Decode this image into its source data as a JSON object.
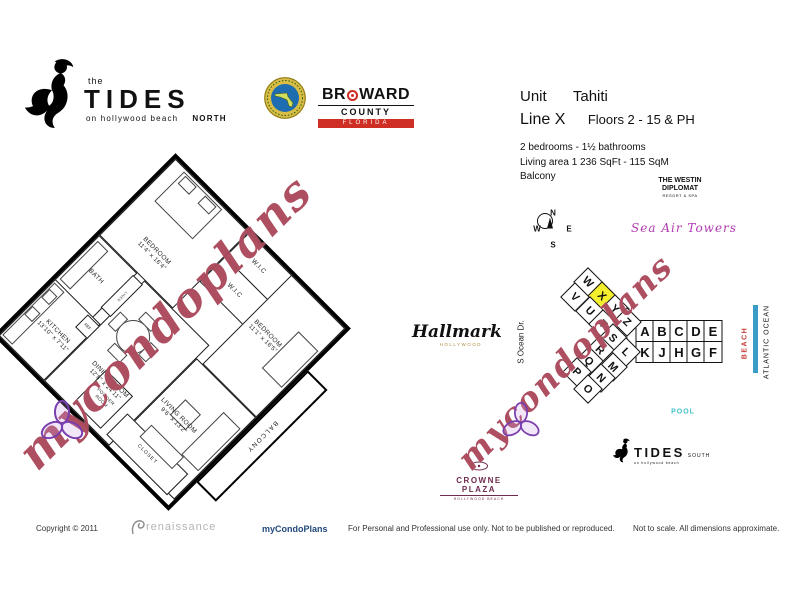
{
  "header": {
    "tides_north": {
      "the": "the",
      "name": "TIDES",
      "tagline": "on hollywood beach",
      "region": "NORTH"
    },
    "broward": {
      "line1a": "BR",
      "line1b": "WARD",
      "line2": "COUNTY",
      "line3": "FLORIDA"
    },
    "unit_info": {
      "unit_label": "Unit",
      "unit_name": "Tahiti",
      "line_label": "Line X",
      "floors": "Floors 2 - 15 & PH",
      "bedrooms": "2 bedrooms - 1½ bathrooms",
      "living_area": "Living area  1 236  SqFt - 115  SqM",
      "balcony": "Balcony"
    }
  },
  "floor_plan": {
    "rooms": [
      {
        "name": "BEDROOM",
        "dims": "11'4\" x 16'4\""
      },
      {
        "name": "W.I.C",
        "dims": ""
      },
      {
        "name": "W.I.C",
        "dims": ""
      },
      {
        "name": "BEDROOM",
        "dims": "11'1\" x 16'5\""
      },
      {
        "name": "BATH",
        "dims": ""
      },
      {
        "name": "KITCHEN",
        "dims": "13'10\" x 7'11\""
      },
      {
        "name": "DINING ROOM",
        "dims": "12'8\" x 24'11\""
      },
      {
        "name": "LIVING ROOM",
        "dims": "9'6\" x 13'2\""
      },
      {
        "name": "BALCONY",
        "dims": ""
      },
      {
        "name": "POWDER ROOM",
        "dims": ""
      },
      {
        "name": "CLOSET",
        "dims": ""
      },
      {
        "name": "REF",
        "dims": ""
      },
      {
        "name": "LINEN",
        "dims": ""
      }
    ]
  },
  "watermark": {
    "text": "mycondoplans",
    "color": "#96201f"
  },
  "site_map": {
    "compass": {
      "n": "N",
      "s": "S",
      "e": "E",
      "w": "W"
    },
    "westin": {
      "line1": "THE WESTIN",
      "line2": "DIPLOMAT",
      "line3": "RESORT & SPA"
    },
    "sea_air_tower": "Sea Air Towers",
    "hallmark": {
      "name": "Hallmark",
      "sub": "HOLLYWOOD"
    },
    "s_ocean_dr": "S Ocean Dr.",
    "beach": "BEACH",
    "atlantic_ocean": "ATLANTIC OCEAN",
    "pool": "POOL",
    "crowne_plaza": {
      "name": "CROWNE PLAZA",
      "sub": "HOLLYWOOD BEACH"
    },
    "tides_south": {
      "name": "TIDES",
      "region": "SOUTH",
      "tagline": "on hollywood beach"
    },
    "highlight_color": "#f4ef2c",
    "highlighted_unit": "X",
    "units": [
      {
        "l": "A",
        "x": 645,
        "y": 331,
        "r": 0
      },
      {
        "l": "B",
        "x": 662,
        "y": 331,
        "r": 0
      },
      {
        "l": "C",
        "x": 679,
        "y": 331,
        "r": 0
      },
      {
        "l": "D",
        "x": 696,
        "y": 331,
        "r": 0
      },
      {
        "l": "E",
        "x": 713,
        "y": 331,
        "r": 0
      },
      {
        "l": "K",
        "x": 645,
        "y": 352,
        "r": 0
      },
      {
        "l": "J",
        "x": 662,
        "y": 352,
        "r": 0
      },
      {
        "l": "H",
        "x": 679,
        "y": 352,
        "r": 0
      },
      {
        "l": "G",
        "x": 696,
        "y": 352,
        "r": 0
      },
      {
        "l": "F",
        "x": 713,
        "y": 352,
        "r": 0
      },
      {
        "l": "W",
        "x": 588,
        "y": 282,
        "r": 45
      },
      {
        "l": "X",
        "x": 602,
        "y": 296,
        "r": 45,
        "hl": true
      },
      {
        "l": "Y",
        "x": 615,
        "y": 309,
        "r": 45
      },
      {
        "l": "Z",
        "x": 627,
        "y": 322,
        "r": 45
      },
      {
        "l": "V",
        "x": 575,
        "y": 297,
        "r": 45
      },
      {
        "l": "U",
        "x": 590,
        "y": 311,
        "r": 45
      },
      {
        "l": "T",
        "x": 603,
        "y": 324,
        "r": 45
      },
      {
        "l": "S",
        "x": 613,
        "y": 338,
        "r": 45
      },
      {
        "l": "R",
        "x": 600,
        "y": 350,
        "r": 45
      },
      {
        "l": "Q",
        "x": 589,
        "y": 361,
        "r": 45
      },
      {
        "l": "P",
        "x": 577,
        "y": 372,
        "r": 45
      },
      {
        "l": "L",
        "x": 626,
        "y": 352,
        "r": 45
      },
      {
        "l": "M",
        "x": 613,
        "y": 367,
        "r": 45
      },
      {
        "l": "N",
        "x": 601,
        "y": 378,
        "r": 45
      },
      {
        "l": "O",
        "x": 588,
        "y": 389,
        "r": 45
      }
    ]
  },
  "footer": {
    "copyright": "Copyright © 2011",
    "renaissance": "renaissance",
    "brand": "myCondoPlans",
    "disclaimer": "For Personal and Professional use only.  Not to be published or reproduced.",
    "scale_note": "Not to scale.  All dimensions approximate."
  }
}
